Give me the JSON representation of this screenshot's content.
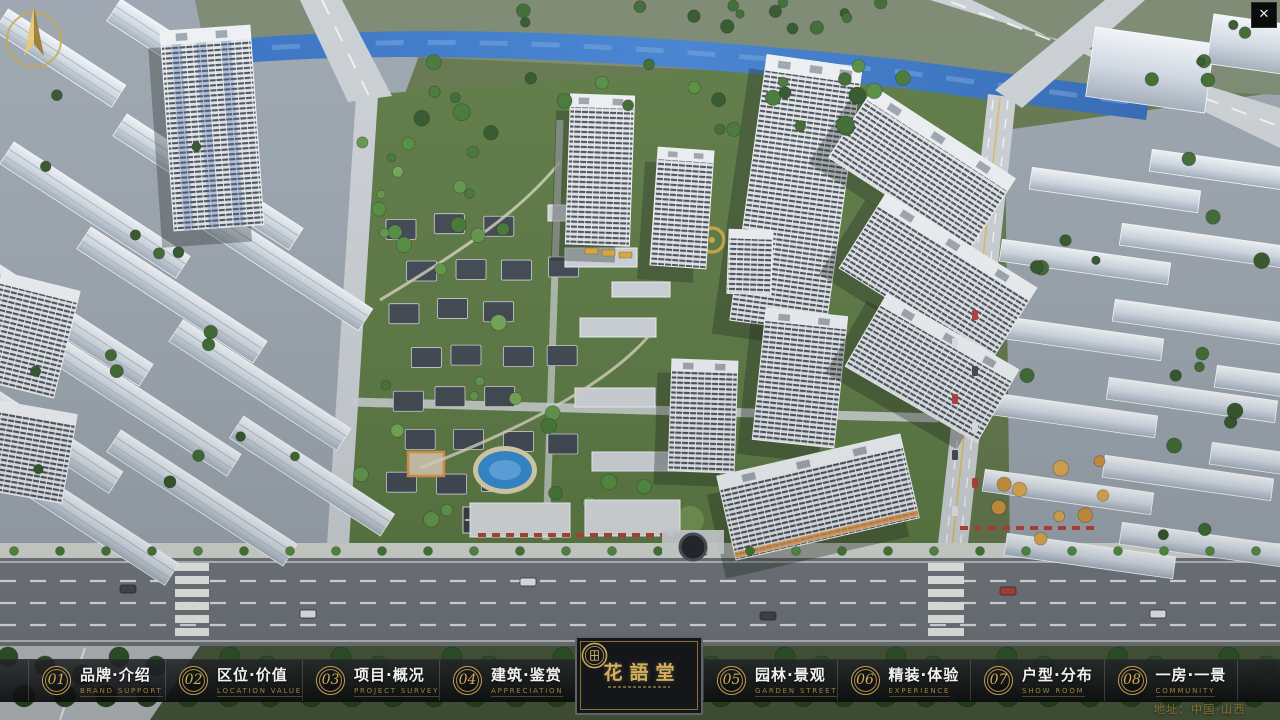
{
  "window": {
    "close_glyph": "✕"
  },
  "compass": {
    "direction": "north"
  },
  "navbar": {
    "items": [
      {
        "num": "01",
        "zh": "品牌·介绍",
        "en": "BRAND SUPPORT"
      },
      {
        "num": "02",
        "zh": "区位·价值",
        "en": "LOCATION VALUE"
      },
      {
        "num": "03",
        "zh": "项目·概况",
        "en": "PROJECT SURVEY"
      },
      {
        "num": "04",
        "zh": "建筑·鉴赏",
        "en": "APPRECIATION"
      },
      {
        "num": "05",
        "zh": "园林·景观",
        "en": "GARDEN STREET"
      },
      {
        "num": "06",
        "zh": "精装·体验",
        "en": "EXPERIENCE"
      },
      {
        "num": "07",
        "zh": "户型·分布",
        "en": "SHOW ROOM"
      },
      {
        "num": "08",
        "zh": "一房·一景",
        "en": "COMMUNITY"
      }
    ]
  },
  "logo": {
    "title": "花語堂"
  },
  "footer": {
    "address": "地址：中国·山西"
  },
  "colors": {
    "gold": "#c9a959",
    "bar_bg": "#141619",
    "river": "#2e6cc0",
    "grass": "#57753e",
    "city_gray": "#98a2ac"
  }
}
